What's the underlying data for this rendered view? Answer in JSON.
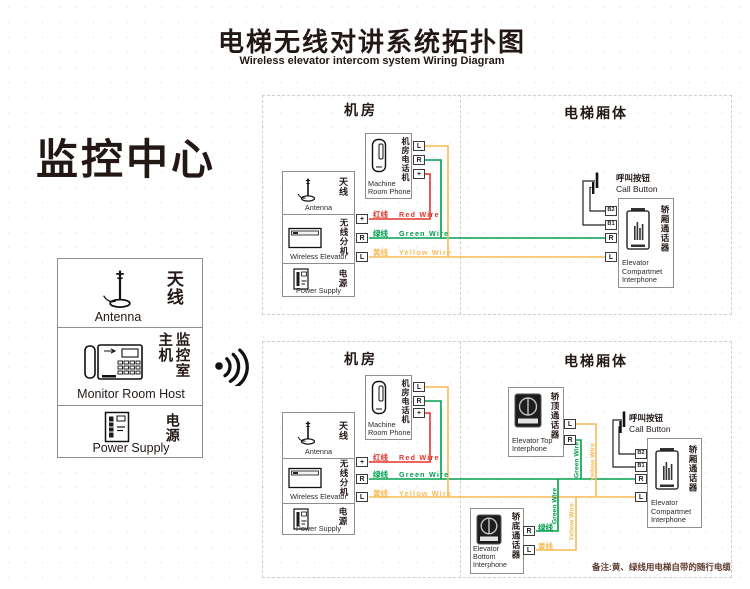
{
  "title": {
    "zh": "电梯无线对讲系统拓扑图",
    "en": "Wireless elevator intercom system Wiring Diagram"
  },
  "monitor": {
    "heading": "监控中心",
    "antenna_zh": "天线",
    "antenna_en": "Antenna",
    "host_zh_left": "主机",
    "host_zh_right": "监控室",
    "host_en": "Monitor Room Host",
    "power_zh": "电源",
    "power_en": "Power Supply"
  },
  "colors": {
    "red_wire": "#e3342b",
    "green_wire": "#00a04d",
    "yellow_wire": "#f6bb55",
    "ink": "#231815",
    "box_border": "#8f8f8f"
  },
  "top": {
    "room_label": "机房",
    "car_label": "电梯厢体",
    "phone": {
      "zh": "机房电话机",
      "en1": "Machine",
      "en2": "Room Phone",
      "tL": "L",
      "tR": "R",
      "tP": "+"
    },
    "station": {
      "antenna_zh": "天线",
      "antenna_en": "Antenna",
      "wireless_zh": "无线分机",
      "wireless_en": "Wireless Elevator",
      "power_zh": "电源",
      "power_en": "Power Supply",
      "tP": "+",
      "tR": "R",
      "tL": "L"
    },
    "wires": {
      "red_zh": "红线",
      "red_en": "Red Wire",
      "green_zh": "绿线",
      "green_en": "Green Wire",
      "yellow_zh": "黄线",
      "yellow_en": "Yellow Wire"
    },
    "call": {
      "zh": "呼叫按钮",
      "en": "Call Button"
    },
    "comp": {
      "zh": "轿厢通话器",
      "en1": "Elevator",
      "en2": "Compartmet",
      "en3": "Interphone",
      "tB2": "B2",
      "tB1": "B1",
      "tR": "R",
      "tL": "L"
    }
  },
  "bottom": {
    "room_label": "机房",
    "car_label": "电梯厢体",
    "phone": {
      "zh": "机房电话机",
      "en1": "Machine",
      "en2": "Room Phone",
      "tL": "L",
      "tR": "R",
      "tP": "+"
    },
    "station": {
      "antenna_zh": "天线",
      "antenna_en": "Antenna",
      "wireless_zh": "无线分机",
      "wireless_en": "Wireless Elevator",
      "power_zh": "电源",
      "power_en": "Power Supply",
      "tP": "+",
      "tR": "R",
      "tL": "L"
    },
    "wires": {
      "red_zh": "红线",
      "red_en": "Red Wire",
      "green_zh": "绿线",
      "green_en": "Green Wire",
      "yellow_zh": "黄线",
      "yellow_en": "Yellow Wire"
    },
    "call": {
      "zh": "呼叫按钮",
      "en": "Call Button"
    },
    "comp": {
      "zh": "轿厢通话器",
      "en1": "Elevator",
      "en2": "Compartmet",
      "en3": "Interphone",
      "tB2": "B2",
      "tB1": "B1",
      "tR": "R",
      "tL": "L"
    },
    "top_itf": {
      "zh": "轿顶通话器",
      "en1": "Elevator Top",
      "en2": "Interphone",
      "tL": "L",
      "tR": "R"
    },
    "bot_itf": {
      "zh": "轿底通话器",
      "en1": "Elevator Bottom",
      "en2": "Interphone",
      "tR": "R",
      "tL": "L",
      "green_zh": "绿线",
      "yellow_zh": "黄线"
    },
    "vlabels": {
      "green": "Green Wire",
      "yellow": "Yellow Wire"
    },
    "note": "备注:黄、绿线用电梯自带的随行电缆"
  }
}
